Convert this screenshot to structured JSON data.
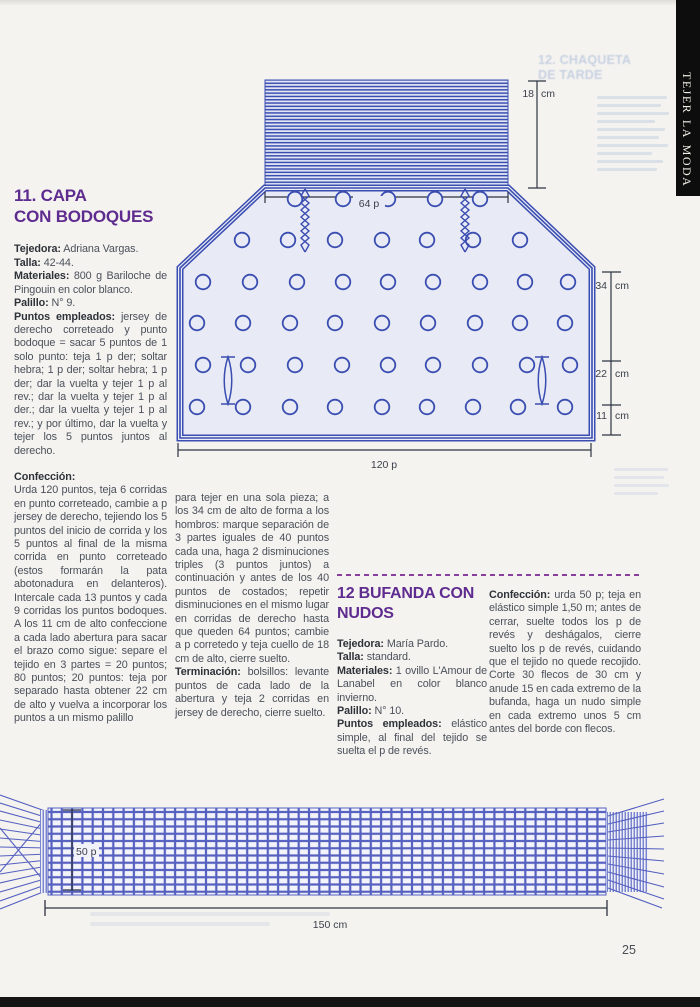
{
  "page": {
    "number": "25"
  },
  "sidebar": {
    "vertical_label": "tejer la moda"
  },
  "colors": {
    "accent_purple": "#5e2b8f",
    "diagram_blue": "#3a4db0",
    "scarf_blue": "#5560c0",
    "ink": "#4b505a",
    "paper": "#f4f3f0",
    "bar_black": "#0d0d0d"
  },
  "section11": {
    "heading_line1": "11.  CAPA",
    "heading_line2": "CON BODOQUES",
    "details": [
      {
        "label": "Tejedora:",
        "text": "Adriana Vargas."
      },
      {
        "label": "Talla:",
        "text": "42-44."
      },
      {
        "label": "Materiales:",
        "text": "800 g Bariloche de Pingouin en color blanco."
      },
      {
        "label": "Palillo:",
        "text": "N° 9."
      },
      {
        "label": "Puntos empleados:",
        "text": "jersey de derecho correteado y punto bodoque = sacar 5 puntos de 1 solo punto: teja 1 p der; soltar hebra; 1 p der; soltar hebra; 1 p der; dar la vuelta y tejer 1 p al rev.; dar la vuelta y tejer 1 p al der.; dar la vuelta y tejer 1 p al rev.; y por último, dar la vuelta y tejer los 5 puntos juntos al derecho."
      }
    ],
    "confeccion_label": "Confección:",
    "confeccion_text": "Urda 120 puntos, teja 6 corridas en punto correteado, cambie a p jersey de derecho, tejiendo los 5 puntos del inicio de corrida y los 5 puntos al final de la misma corrida en punto correteado (estos formarán la pata abotonadura en delanteros). Intercale cada 13 puntos y cada 9 corridas los puntos bodoques. A los 11 cm de alto confeccione a cada lado abertura para sacar el brazo como sigue: separe el tejido en 3 partes = 20 puntos; 80 puntos; 20 puntos: teja por separado hasta obtener 22 cm de alto y vuelva a incorporar los puntos a un mismo palillo",
    "col2_text": "para tejer en una sola pieza; a los 34 cm de alto de forma a los hombros: marque separación de 3 partes iguales de 40 puntos cada una, haga 2 disminuciones triples (3 puntos juntos) a continuación y antes de los 40 puntos de costados; repetir disminuciones en el mismo lugar en corridas de derecho hasta que queden 64 puntos; cambie a p corretedo y teja cuello de 18 cm de alto, cierre suelto.",
    "terminacion_label": "Terminación:",
    "terminacion_text": "bolsillos: levante puntos de cada lado de la abertura y teja 2 corridas en jersey de derecho, cierre suelto."
  },
  "section12": {
    "heading_line1": "12 BUFANDA CON",
    "heading_line2": "NUDOS",
    "details": [
      {
        "label": "Tejedora:",
        "text": "María Pardo."
      },
      {
        "label": "Talla:",
        "text": "standard."
      },
      {
        "label": "Materiales:",
        "text": "1 ovillo L'Amour de Lanabel en color blanco invierno."
      },
      {
        "label": "Palillo:",
        "text": "N° 10."
      },
      {
        "label": "Puntos empleados:",
        "text": "elástico simple, al final del tejido se suelta el p de revés."
      }
    ],
    "confeccion_label": "Confección:",
    "confeccion_text": "urda 50 p; teja en elástico simple 1,50 m; antes de cerrar, suelte todos los p de revés y deshágalos, cierre suelto los p de revés, cuidando que el tejido no quede recojido. Corte 30 flecos de 30 cm y anude 15 en cada extremo de la bufanda, haga un nudo simple en cada extremo unos 5 cm antes del borde con flecos."
  },
  "cape_diagram": {
    "labels": {
      "neck_n": "18",
      "neck_u": "cm",
      "top_width": "64 p",
      "m34_n": "34",
      "m34_u": "cm",
      "m22_n": "22",
      "m22_u": "cm",
      "m11_n": "11",
      "m11_u": "cm",
      "bottom_width": "120 p"
    }
  },
  "scarf_diagram": {
    "labels": {
      "stitches": "50 p",
      "length": "150 cm"
    }
  },
  "ghost_text": {
    "line1": "12. CHAQUETA",
    "line2": "DE TARDE"
  }
}
